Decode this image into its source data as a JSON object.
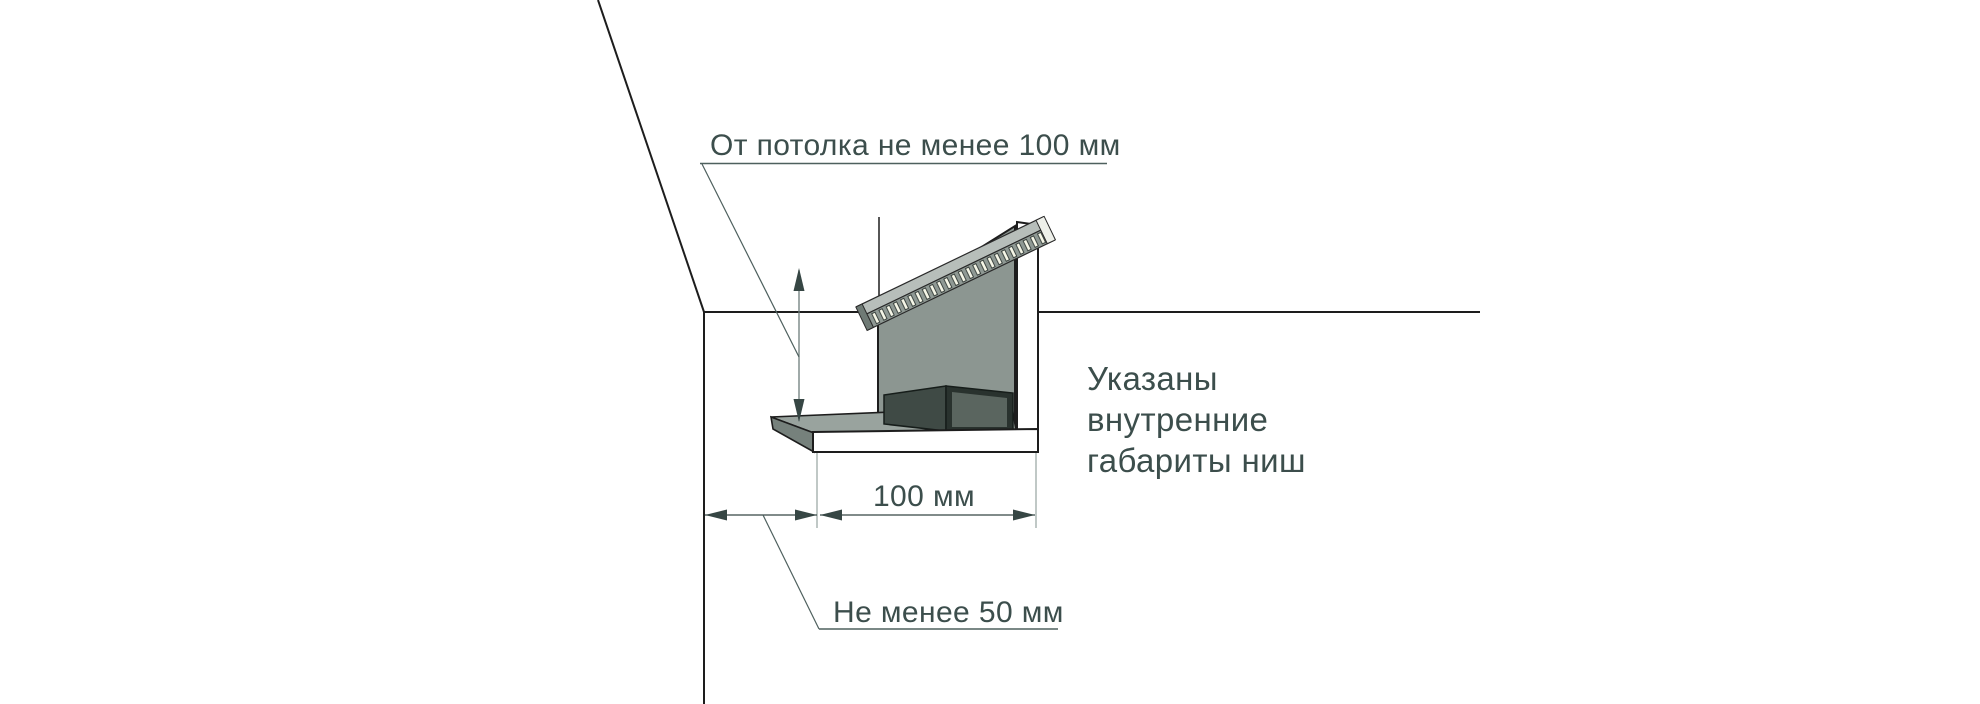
{
  "figure": {
    "labels": {
      "ceiling_clearance": "От потолка не менее 100 мм",
      "niche_width": "100 мм",
      "wall_clearance": "Не менее 50 мм"
    },
    "note_lines": [
      "Указаны",
      "внутренние",
      "габариты ниш"
    ],
    "colors": {
      "background": "#ffffff",
      "outline": "#1d1d1d",
      "text": "#3c4e4c",
      "dimension": "#364644",
      "leader": "#4e605e",
      "panel_gray": "#8c9691",
      "track_top_gray": "#b7beba",
      "track_slot_fill": "#f5f6e7",
      "shelf_gray": "#99a39e",
      "shelf_end_gray": "#76817c",
      "box_dark": "#3f4a45",
      "box_inner": "#5a655f"
    }
  }
}
